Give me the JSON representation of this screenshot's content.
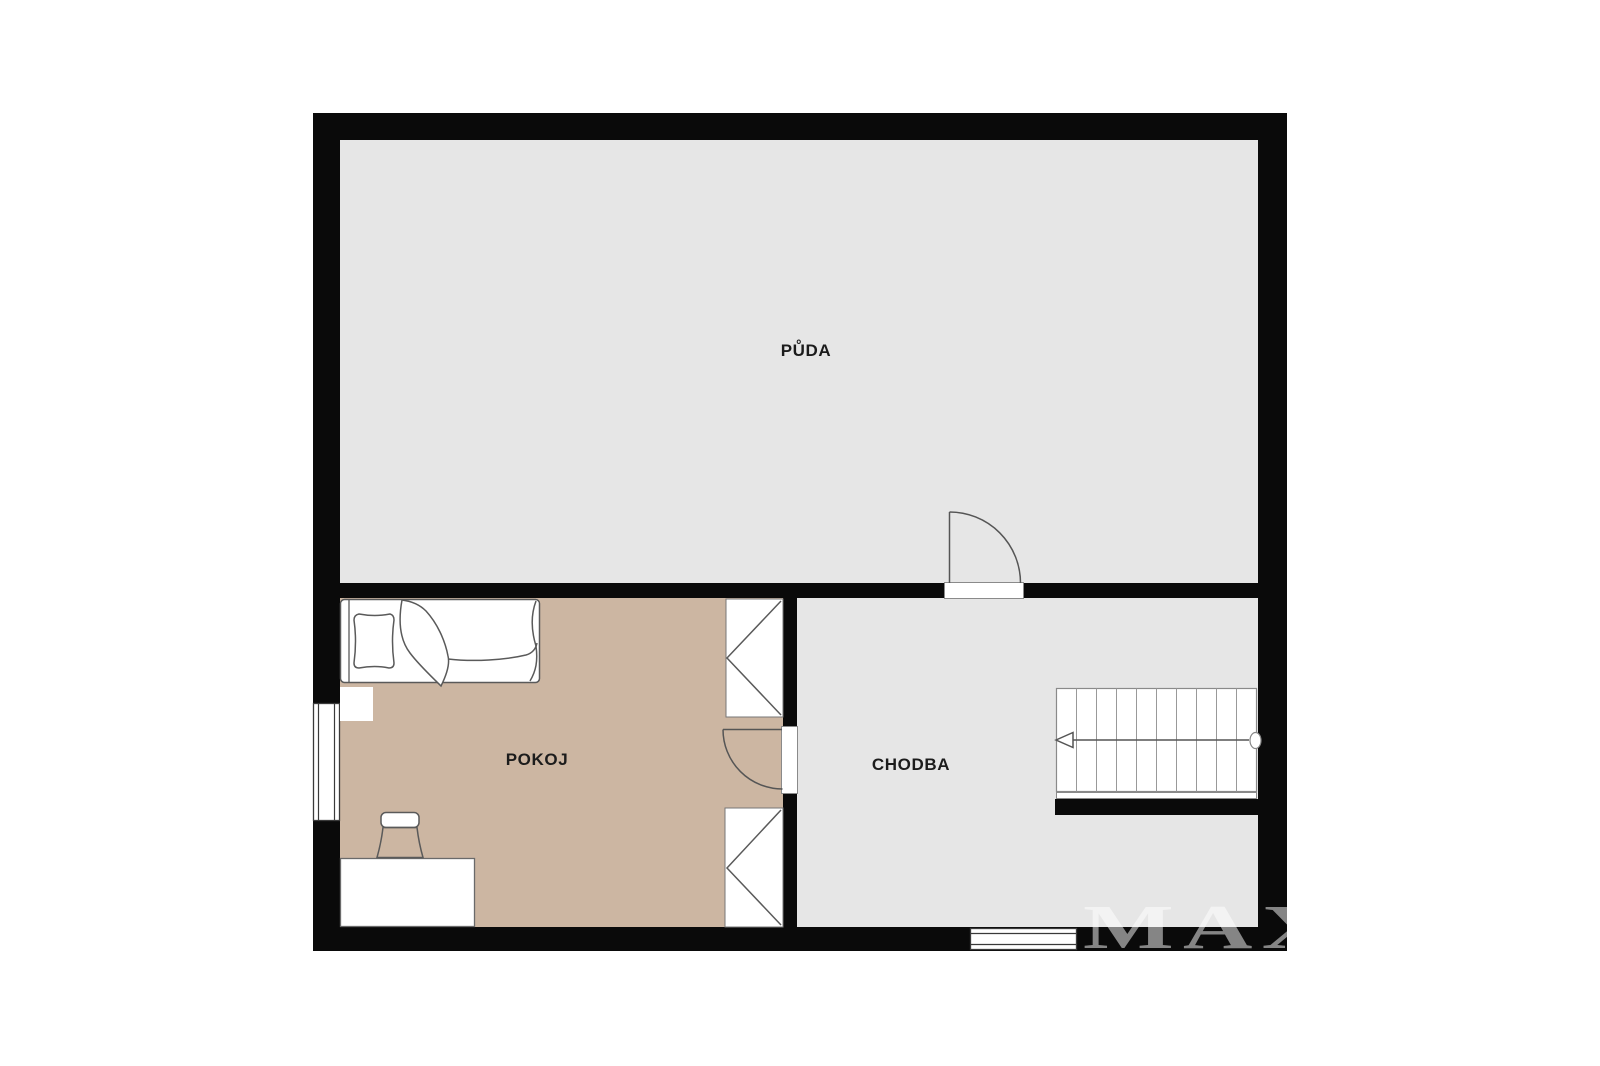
{
  "plan": {
    "title": "floor-plan",
    "watermark": "MAX",
    "rooms": [
      {
        "id": "puda",
        "label": "PŮDA",
        "floor_color": "#e6e6e6"
      },
      {
        "id": "pokoj",
        "label": "POKOJ",
        "floor_color": "#ccb6a2"
      },
      {
        "id": "chodba",
        "label": "CHODBA",
        "floor_color": "#e6e6e6"
      }
    ],
    "colors": {
      "wall": "#0a0a0a",
      "background": "#ffffff",
      "furniture_outline": "#555555",
      "window_frame": "#3a3a3a",
      "label_text": "#1c1c1c",
      "watermark": "rgba(255,255,255,0.5)"
    },
    "symbols": {
      "pokoj": [
        "bed",
        "pillow",
        "blanket",
        "nightstand",
        "desk",
        "chair",
        "wardrobe-upper",
        "wardrobe-lower",
        "window-left",
        "door-to-chodba"
      ],
      "chodba": [
        "staircase",
        "window-bottom",
        "door-to-puda"
      ]
    },
    "staircase": {
      "treads": 10,
      "arrow_direction": "left"
    }
  }
}
